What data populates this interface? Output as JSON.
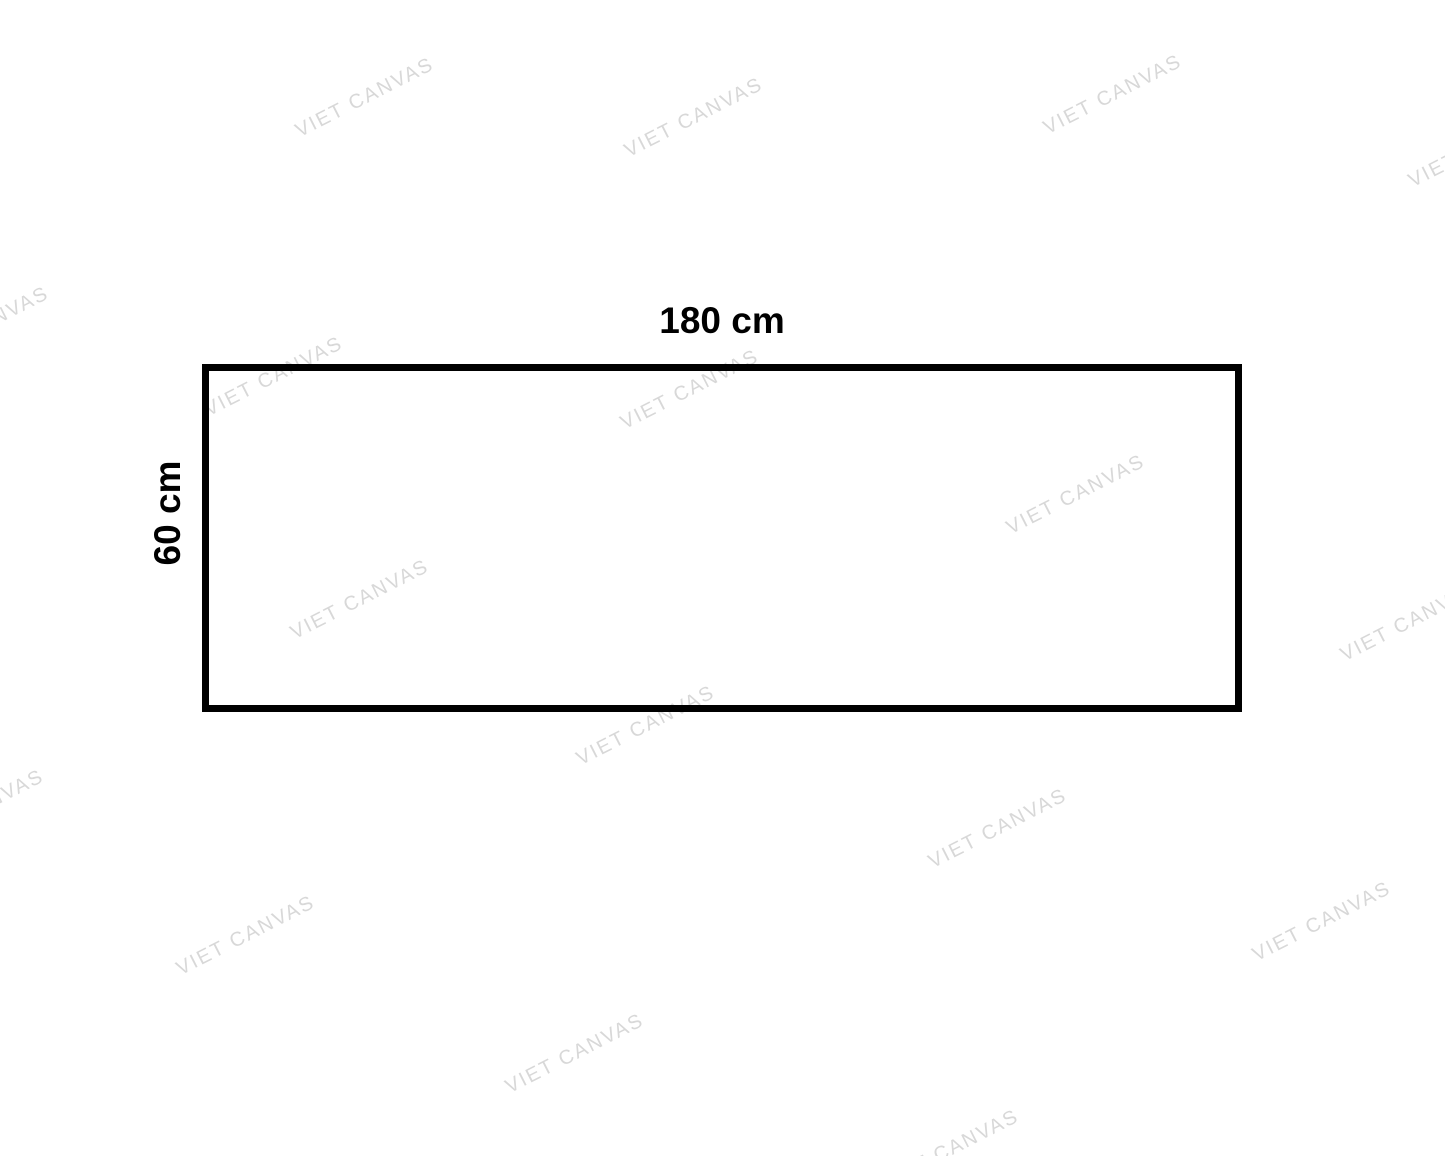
{
  "page": {
    "background_color": "#ffffff"
  },
  "diagram": {
    "width_label": "180 cm",
    "height_label": "60 cm",
    "border_color": "#000000",
    "label_color": "#000000"
  },
  "watermark": {
    "text": "VIET CANVAS",
    "color": "#d8d8d8",
    "angle_deg": -27,
    "positions": [
      {
        "x": 365,
        "y": 98
      },
      {
        "x": 694,
        "y": 118
      },
      {
        "x": 1113,
        "y": 95
      },
      {
        "x": 1478,
        "y": 148
      },
      {
        "x": -20,
        "y": 327
      },
      {
        "x": 274,
        "y": 377
      },
      {
        "x": 690,
        "y": 390
      },
      {
        "x": 360,
        "y": 600
      },
      {
        "x": 1076,
        "y": 495
      },
      {
        "x": 1410,
        "y": 622
      },
      {
        "x": 646,
        "y": 726
      },
      {
        "x": -25,
        "y": 810
      },
      {
        "x": 246,
        "y": 936
      },
      {
        "x": 998,
        "y": 829
      },
      {
        "x": 1322,
        "y": 922
      },
      {
        "x": 575,
        "y": 1054
      },
      {
        "x": 950,
        "y": 1150
      }
    ]
  }
}
